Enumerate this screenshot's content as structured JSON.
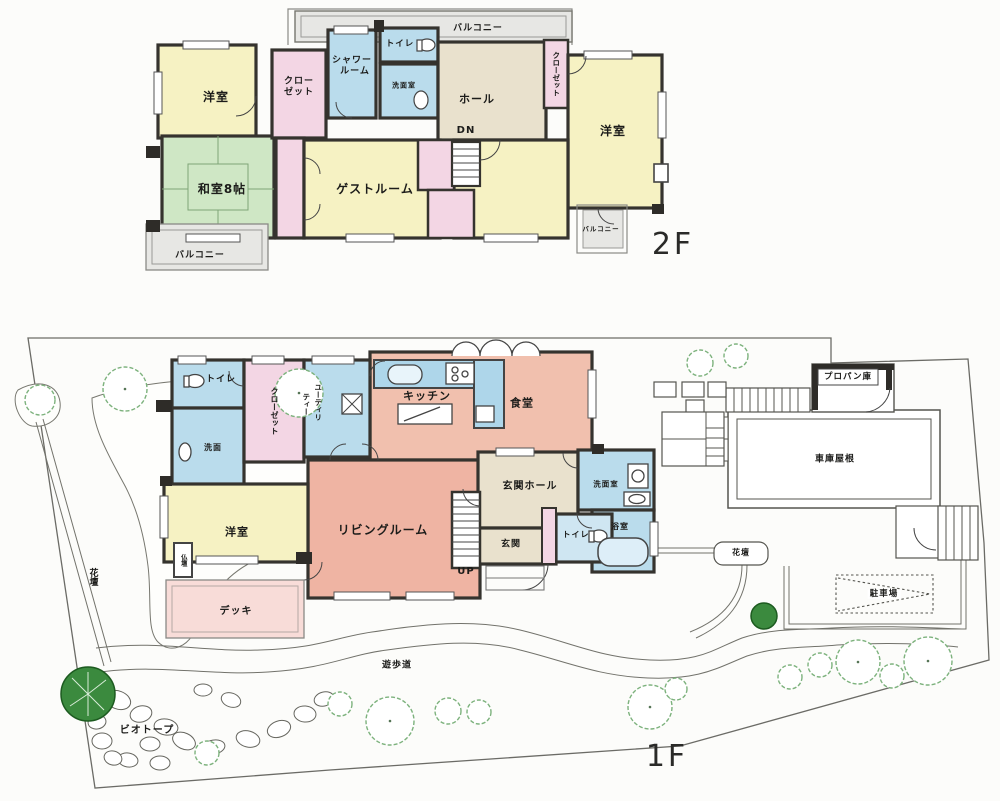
{
  "palette": {
    "room_yellow": "#f6f2c3",
    "room_green": "#cfe7c5",
    "room_pink": "#f3d6e4",
    "room_blue": "#badcec",
    "room_salmon": "#f1c0ae",
    "room_salmon_dark": "#efb4a3",
    "room_beige": "#e9e1cd",
    "balcony_gray": "#e7e7e4",
    "deck_pink": "#f8dcd8",
    "wall_dark": "#35332e",
    "tree_green": "#7db27d",
    "tree_dark": "#3b8a3e"
  },
  "floor2": {
    "floor_label": "2F",
    "labels": {
      "balcony_top": "バルコニー",
      "bedroom_left": "洋室",
      "closet_l1": "クロー",
      "closet_l2": "ゼット",
      "shower_1": "シャワー",
      "shower_2": "ルーム",
      "toilet": "トイレ",
      "washroom": "洗面室",
      "hall": "ホール",
      "down": "DN",
      "closet_right": "クローゼット",
      "bedroom_right": "洋室",
      "tatami_room": "和室8帖",
      "guest_room": "ゲストルーム",
      "balcony_bl": "バルコニー",
      "balcony_br": "バルコニー"
    }
  },
  "floor1": {
    "floor_label": "1F",
    "labels": {
      "toilet": "トイレ",
      "washbasin": "洗面",
      "closet": "クローゼット",
      "utility_1": "ユーティリ",
      "utility_2": "ティー",
      "kitchen": "キッチン",
      "dining": "食堂",
      "living": "リビングルーム",
      "bedroom": "洋室",
      "butsudan": "仏壇",
      "deck": "デッキ",
      "entrance_hall": "玄関ホール",
      "entrance": "玄関",
      "up": "UP",
      "toilet_b": "トイレ",
      "washroom": "洗面室",
      "bath": "浴室",
      "flowerbed_right": "花壇",
      "flowerbed_left": "花壇",
      "parking": "駐車場",
      "garage_roof": "車庫屋根",
      "propane": "プロパン庫",
      "promenade": "遊歩道",
      "biotope": "ビオトープ"
    }
  }
}
